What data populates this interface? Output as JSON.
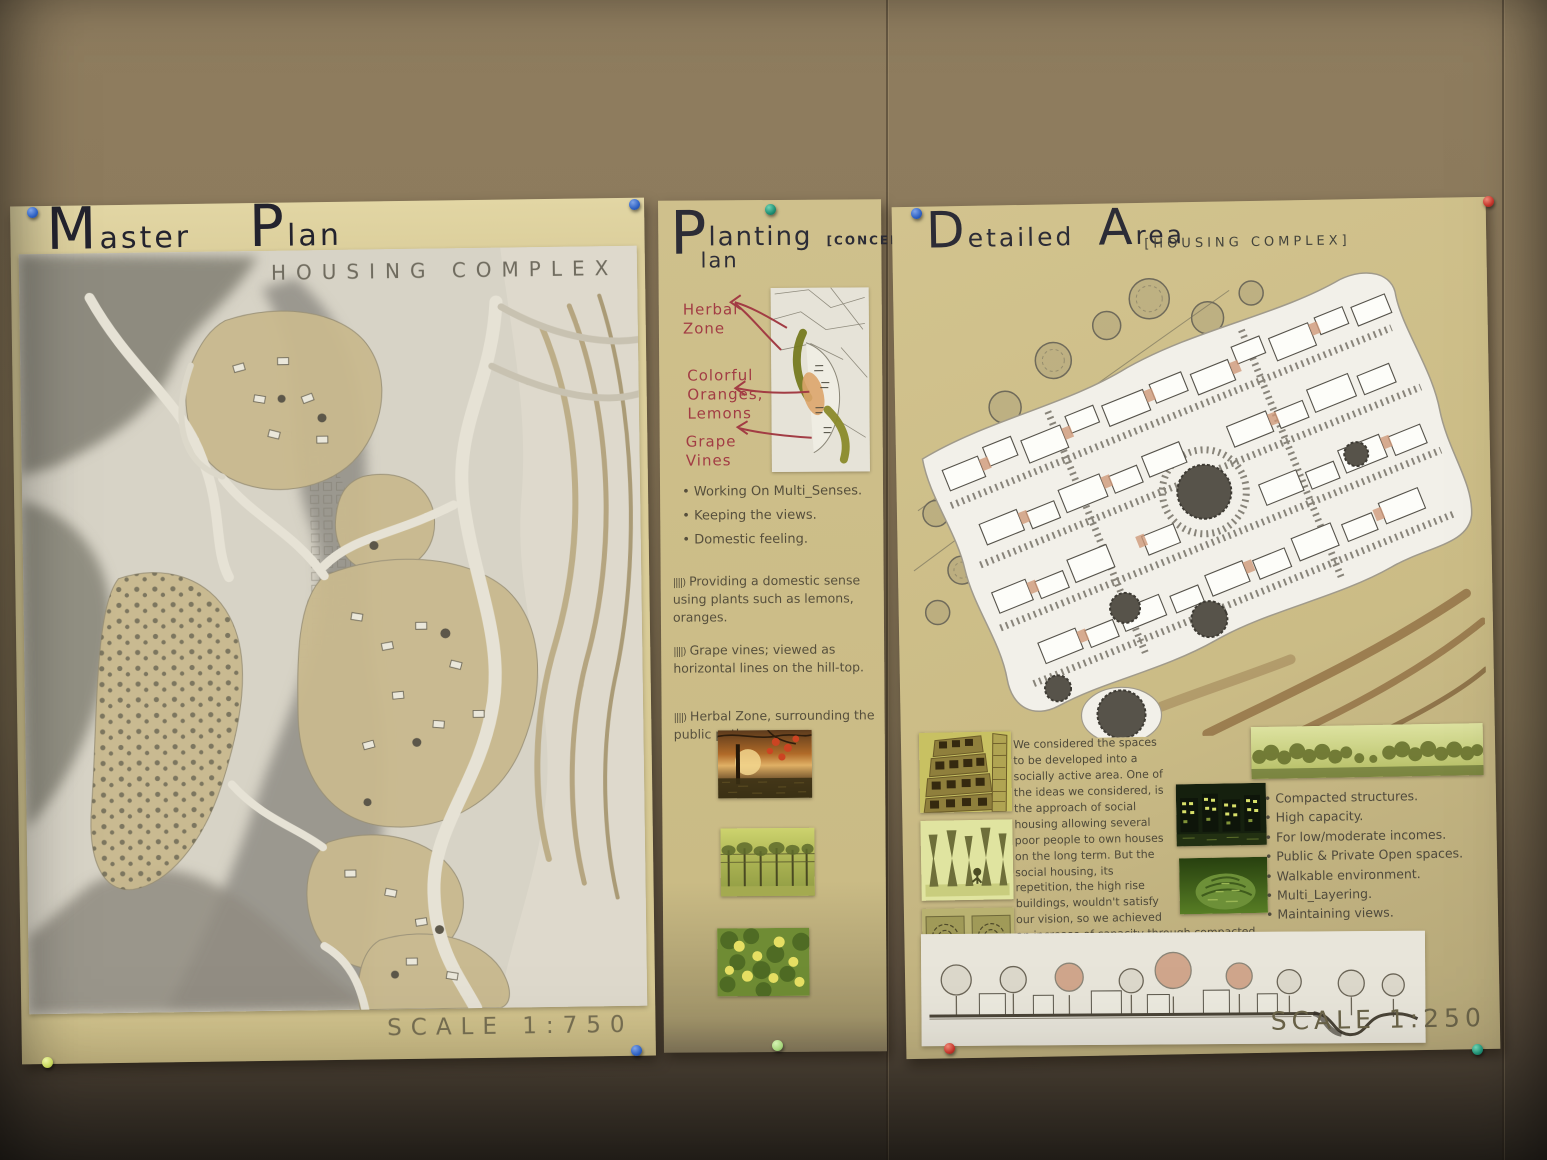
{
  "colors": {
    "wall": "#8a795c",
    "poster_paper": "#cfc08c",
    "map_paper": "#d7d3c6",
    "title_ink": "#2c2c36",
    "pencil_text": "#564f3c",
    "label_red": "#a23c44",
    "olive_band": "#7b7b24",
    "pin_blue": "#2f62c4",
    "pin_green": "#1f8f74",
    "pin_red": "#c5352b",
    "pin_yellow_green": "#c9d95e",
    "pin_light_green": "#a8d77e"
  },
  "poster_master_plan": {
    "title_word1": "Master",
    "title_word2": "Plan",
    "subtitle": "HOUSING COMPLEX",
    "scale_label": "SCALE 1:750"
  },
  "poster_planting": {
    "title_initial": "P",
    "title_word1_rest": "lanting",
    "title_word2_rest": "lan",
    "concept_tag": "[CONCEPT]",
    "map_labels": [
      "Herbal\nZone",
      "Colorful\nOranges,\nLemons",
      "Grape\nVines"
    ],
    "bullets": [
      "Working On Multi_Senses.",
      "Keeping the views.",
      "Domestic feeling."
    ],
    "notes": [
      {
        "marker": "||||)",
        "text": "Providing a domestic sense using plants such as lemons, oranges."
      },
      {
        "marker": "||||)",
        "text": "Grape vines; viewed as horizontal lines on the hill-top."
      },
      {
        "marker": "||||)",
        "text": "Herbal Zone, surrounding the public path."
      }
    ],
    "photo_alts": [
      "orange-trees-at-sunset",
      "grape-vineyard",
      "lemon-tree"
    ]
  },
  "poster_detailed": {
    "title_word1": "Detailed",
    "title_word2": "Area",
    "concept_tag": "[HOUSING COMPLEX]",
    "paragraph": "We considered the spaces to be developed into a socially active area. One of the ideas we considered, is the approach of social housing allowing several poor people to own houses on the long term. But the social housing, its repetition, the high rise buildings, wouldn't satisfy our vision, so we achieved an increase of capacity through compacted complexes of housing of 2-3 floors rising with the contour providing terraces for each house as a private open spaces.",
    "bullets": [
      "Compacted structures.",
      "High capacity.",
      "For low/moderate incomes.",
      "Public & Private Open spaces.",
      "Walkable environment.",
      "Multi_Layering.",
      "Maintaining views."
    ],
    "photo_alts": [
      "building-collage-sketch",
      "pillars-concept-sketch",
      "plan-texture-sketches",
      "night-buildings-photo",
      "green-terraces-photo",
      "tree-line-panorama"
    ],
    "scale_label": "SCALE 1:250"
  }
}
